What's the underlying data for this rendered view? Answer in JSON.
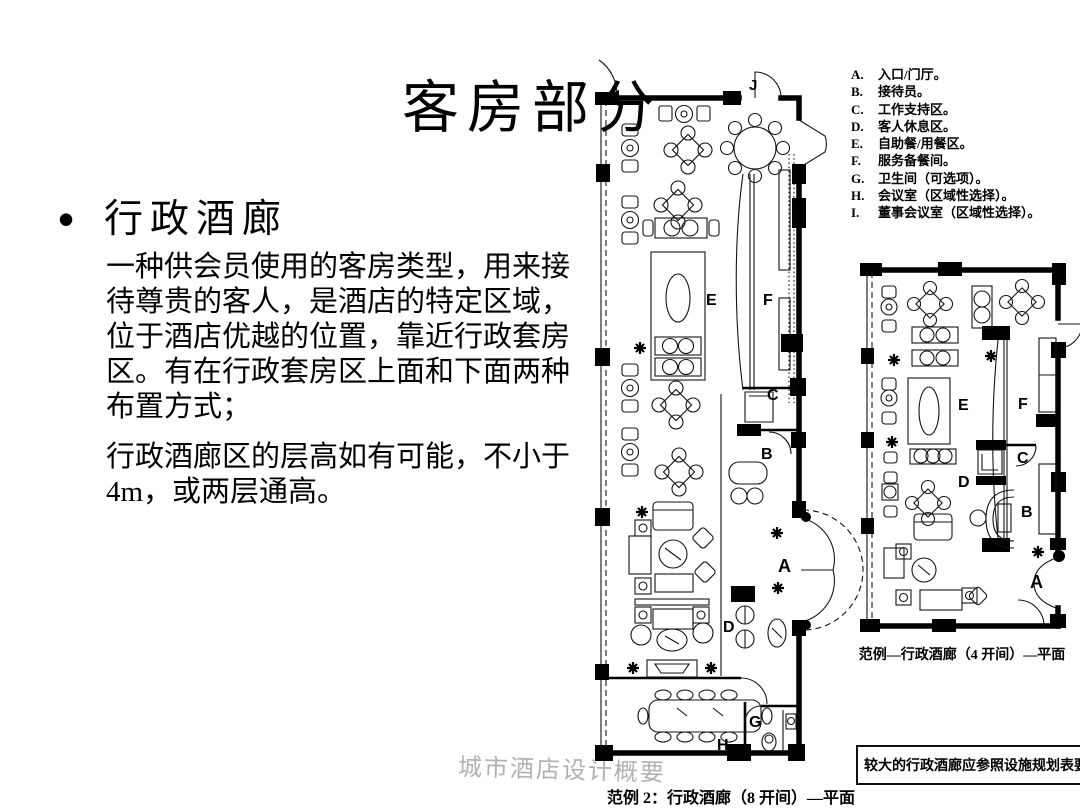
{
  "slide": {
    "title": "客房部分",
    "bullet_char": "•",
    "heading": "行政酒廊",
    "para1": "一种供会员使用的客房类型，用来接待尊贵的客人，是酒店的特定区域，位于酒店优越的位置，靠近行政套房区。有在行政套房区上面和下面两种布置方式；",
    "para2": "行政酒廊区的层高如有可能，不小于4m，或两层通高。",
    "watermark": "城市酒店设计概要"
  },
  "legend": {
    "items": [
      {
        "key": "A.",
        "label": "入口/门厅。"
      },
      {
        "key": "B.",
        "label": "接待员。"
      },
      {
        "key": "C.",
        "label": "工作支持区。"
      },
      {
        "key": "D.",
        "label": "客人休息区。"
      },
      {
        "key": "E.",
        "label": "自助餐/用餐区。"
      },
      {
        "key": "F.",
        "label": "服务备餐间。"
      },
      {
        "key": "G.",
        "label": "卫生间（可选项）。"
      },
      {
        "key": "H.",
        "label": "会议室（区域性选择）。"
      },
      {
        "key": "I.",
        "label": "董事会议室（区域性选择）。"
      }
    ]
  },
  "plan_large": {
    "caption": "范例 2：行政酒廊（8 开间）—平面",
    "labels": {
      "j": "J",
      "e": "E",
      "f": "F",
      "c": "C",
      "b": "B",
      "a": "A",
      "d": "D",
      "g": "G",
      "h": "H"
    }
  },
  "plan_small": {
    "caption": "范例—行政酒廊（4 开间）—平面",
    "labels": {
      "e": "E",
      "f": "F",
      "c": "C",
      "d": "D",
      "b": "B",
      "a": "A"
    }
  },
  "note_box": {
    "text": "较大的行政酒廊应参照设施规划表要求"
  },
  "colors": {
    "background": "#ffffff",
    "text": "#000000",
    "watermark": "#b3b0b0",
    "plan_lines": "#000000"
  }
}
